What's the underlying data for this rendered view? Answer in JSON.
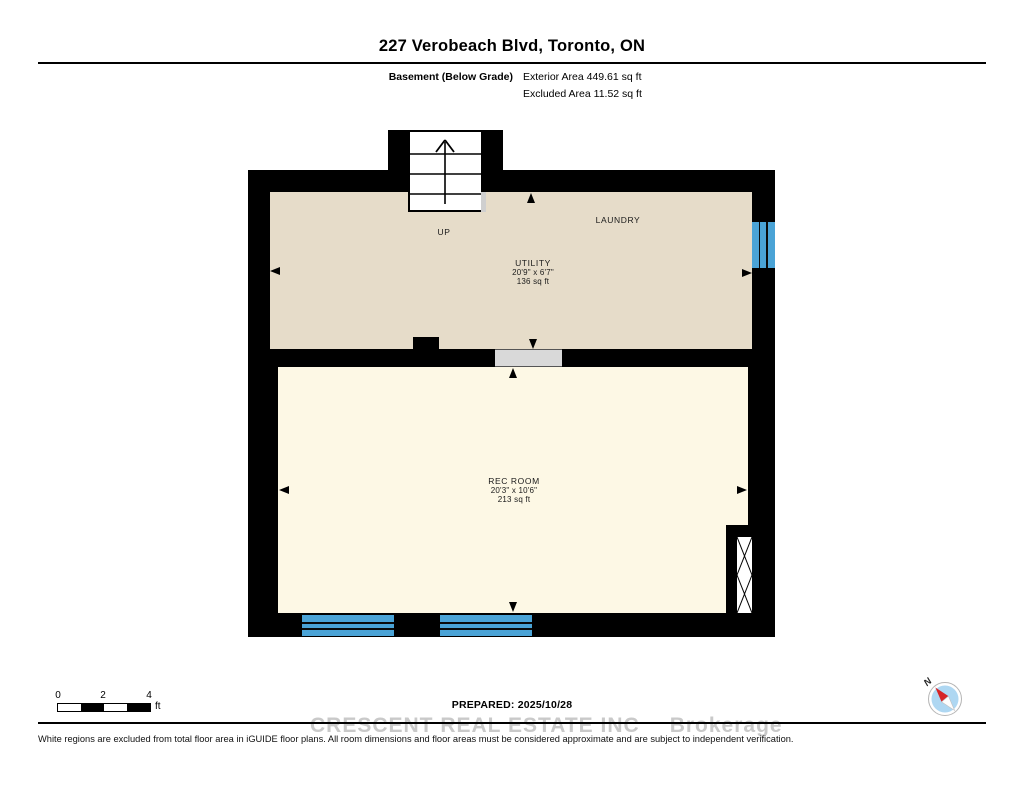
{
  "header": {
    "title": "227 Verobeach Blvd, Toronto, ON",
    "floor_label": "Basement (Below Grade)",
    "exterior_area": "Exterior Area 449.61 sq ft",
    "excluded_area": "Excluded Area 11.52 sq ft"
  },
  "plan": {
    "labels": {
      "up": "UP",
      "laundry": "LAUNDRY"
    },
    "rooms": [
      {
        "name": "UTILITY",
        "dims": "20'9\" x 6'7\"",
        "area": "136 sq ft"
      },
      {
        "name": "REC ROOM",
        "dims": "20'3\" x 10'6\"",
        "area": "213 sq ft"
      }
    ],
    "colors": {
      "wall": "#000000",
      "utility_floor": "#e6dcc9",
      "rec_floor": "#fdf8e5",
      "window_blue": "#4aa3d6",
      "door_gray": "#d9d9d9",
      "excluded_white": "#ffffff"
    }
  },
  "footer": {
    "scale": {
      "labels": [
        "0",
        "2",
        "4"
      ],
      "unit": "ft"
    },
    "prepared": "PREPARED: 2025/10/28",
    "watermark_line1": "CRESCENT REAL ESTATE INC",
    "watermark_line2": "Brokerage",
    "compass_n": "N",
    "disclaimer": "White regions are excluded from total floor area in iGUIDE floor plans. All room dimensions and floor areas must be considered approximate and are subject to independent verification."
  }
}
